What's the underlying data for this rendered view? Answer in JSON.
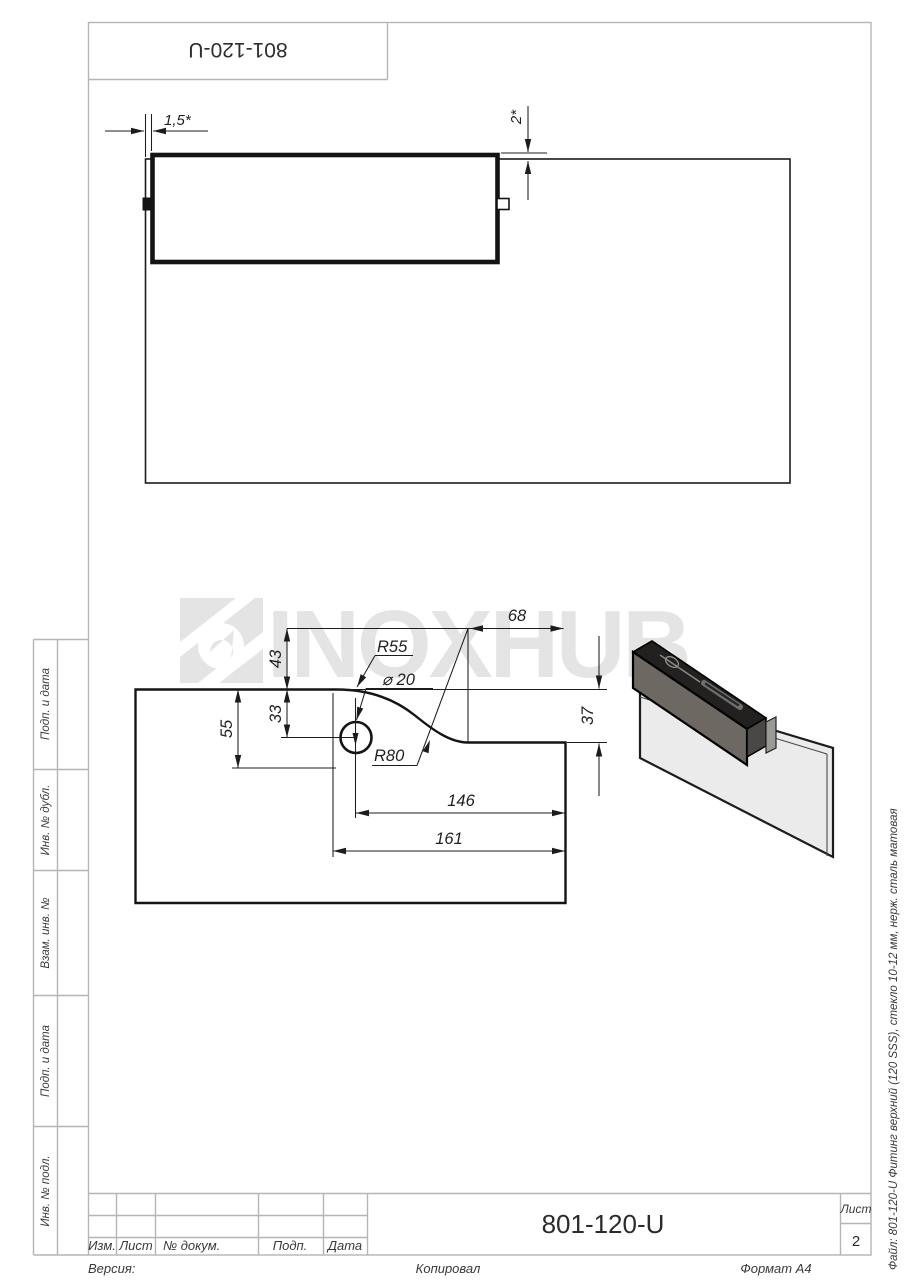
{
  "page": {
    "title_top": "801-120-U",
    "watermark": "INOXHUB"
  },
  "top_view": {
    "dim_gap": "1,5*",
    "dim_offset": "2*"
  },
  "profile_view": {
    "dim_68": "68",
    "dim_43": "43",
    "radius_55": "R55",
    "dia_20": "⌀ 20",
    "dim_55": "55",
    "dim_33": "33",
    "radius_80": "R80",
    "dim_37": "37",
    "dim_146": "146",
    "dim_161": "161"
  },
  "sidebar": {
    "items": [
      {
        "label": "Подп. и дата"
      },
      {
        "label": "Инв. № дубл."
      },
      {
        "label": "Взам. инв. №"
      },
      {
        "label": "Подп. и дата"
      },
      {
        "label": "Инв. № подл."
      }
    ]
  },
  "title_block": {
    "col_izm": "Изм.",
    "col_list": "Лист",
    "col_doc": "№ докум.",
    "col_sign": "Подп.",
    "col_date": "Дата",
    "doc_number": "801-120-U",
    "sheet_label": "Лист",
    "sheet_number": "2"
  },
  "footer": {
    "version": "Версия:",
    "copied": "Копировал",
    "format": "Формат А4"
  },
  "side_note": {
    "file": "Файл: 801-120-U Фитинг верхний (120 SSS), стекло 10-12 мм, нерж. сталь матовая"
  },
  "colors": {
    "line": "#1c1c1c",
    "frame": "#b5b5b5",
    "watermark": "#e4e4e4",
    "fitting_front": "#6d6862",
    "glass": "#ebebeb"
  }
}
